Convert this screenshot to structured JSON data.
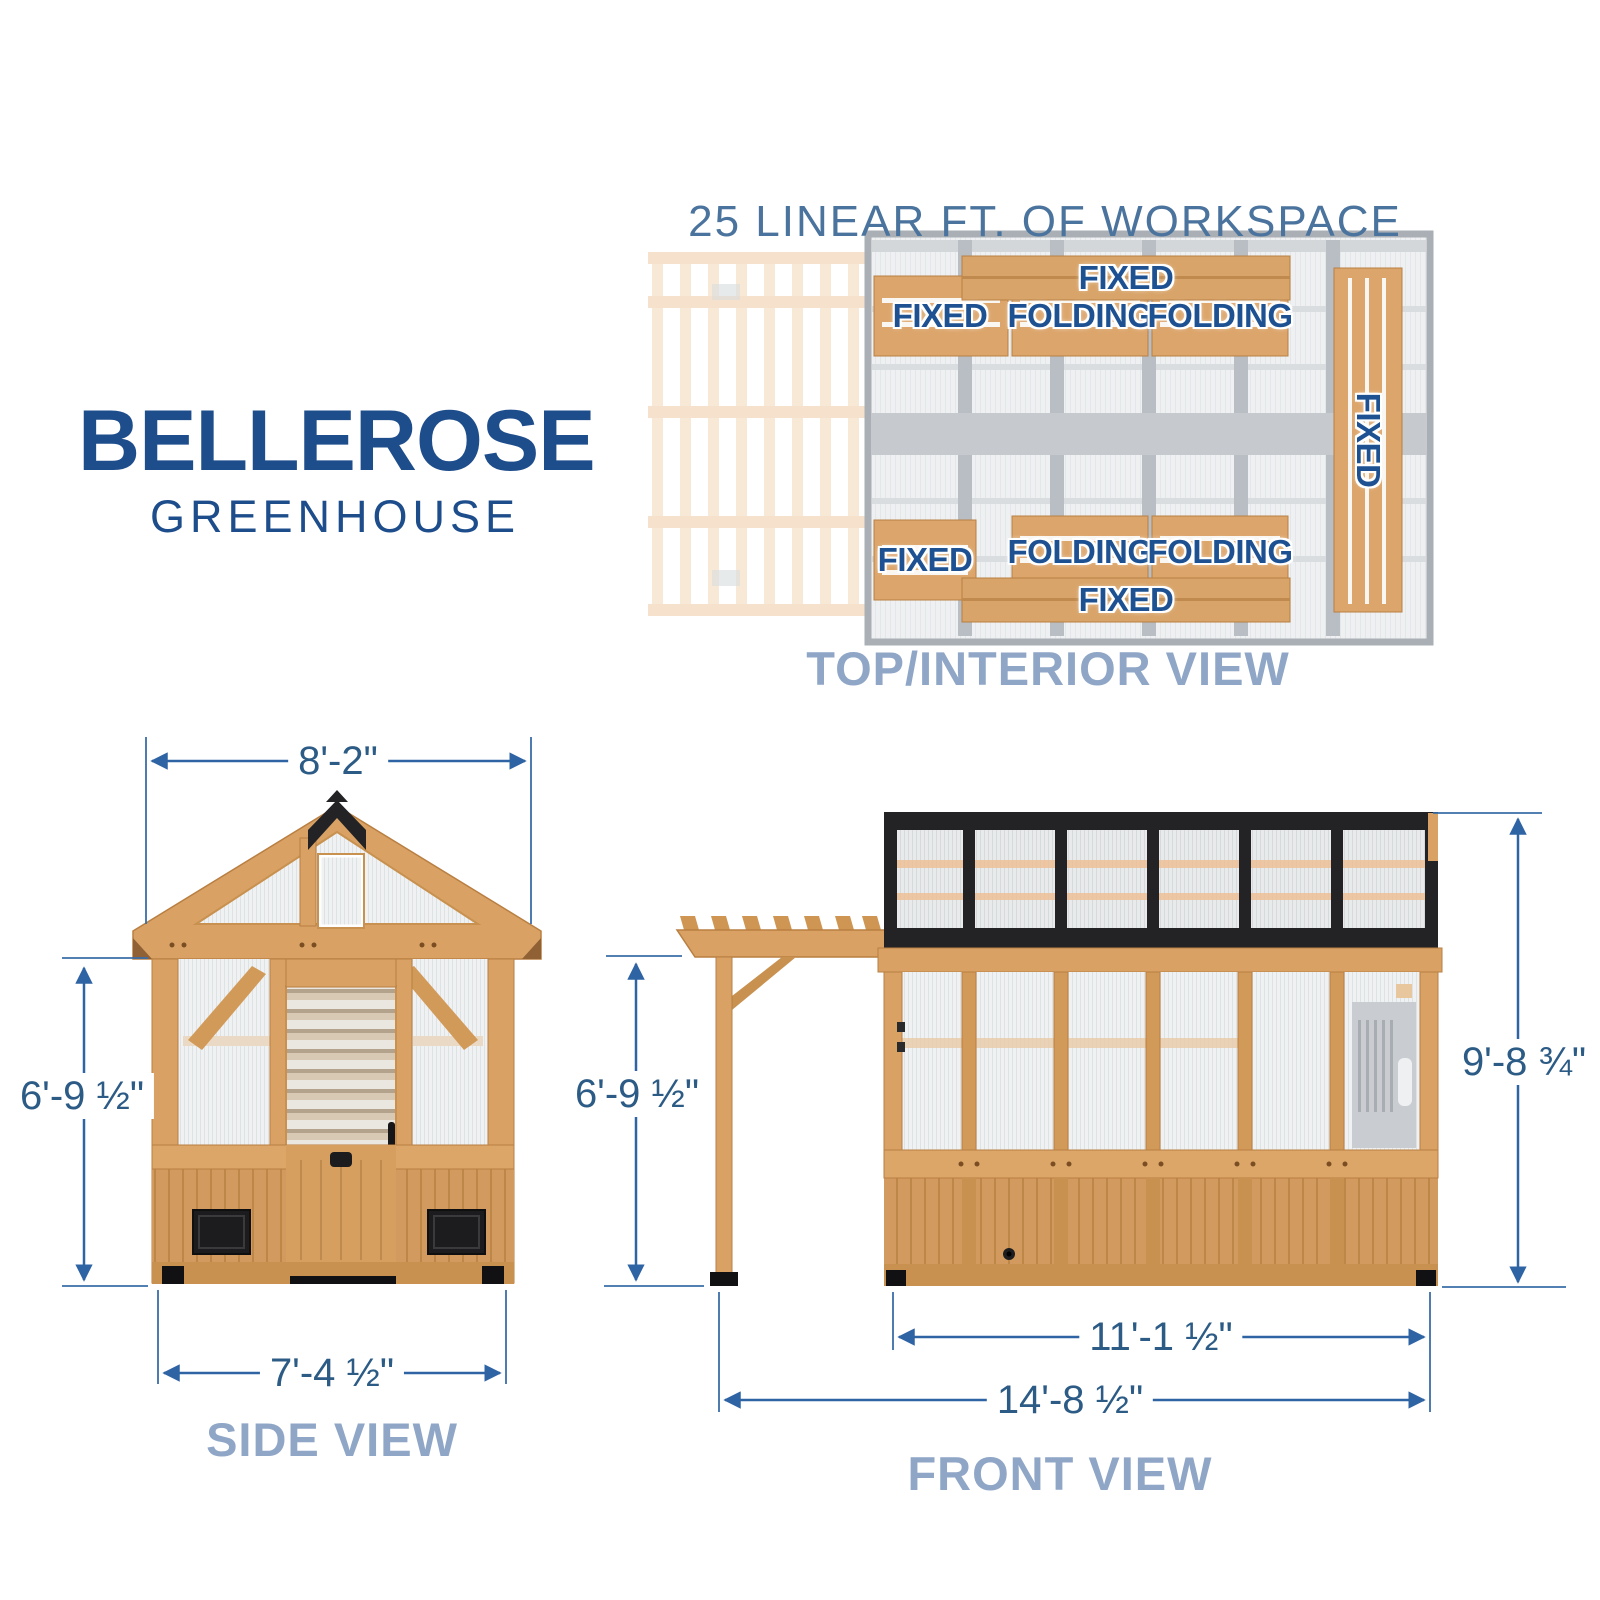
{
  "brand": {
    "name": "BELLEROSE",
    "subtitle": "GREENHOUSE"
  },
  "top_view": {
    "heading": "25 LINEAR FT. OF WORKSPACE",
    "caption": "TOP/INTERIOR VIEW",
    "shelves": [
      {
        "position": "back-wall-plank",
        "type": "FIXED"
      },
      {
        "position": "back-left",
        "type": "FIXED"
      },
      {
        "position": "back-middle",
        "type": "FOLDING"
      },
      {
        "position": "back-right",
        "type": "FOLDING"
      },
      {
        "position": "right-wall",
        "type": "FIXED"
      },
      {
        "position": "front-left",
        "type": "FIXED"
      },
      {
        "position": "front-middle",
        "type": "FOLDING"
      },
      {
        "position": "front-right",
        "type": "FOLDING"
      },
      {
        "position": "front-wall-plank",
        "type": "FIXED"
      }
    ]
  },
  "side_view": {
    "caption": "SIDE VIEW",
    "dimensions": {
      "roof_width": "8'-2\"",
      "wall_height": "6'-9 ½\"",
      "base_width": "7'-4 ½\""
    }
  },
  "front_view": {
    "caption": "FRONT VIEW",
    "dimensions": {
      "pergola_height": "6'-9 ½\"",
      "total_height": "9'-8 ¾\"",
      "greenhouse_width": "11'-1 ½\"",
      "total_width": "14'-8 ½\""
    }
  },
  "colors": {
    "brand_blue": "#1e4d8c",
    "heading_blue": "#4a739d",
    "caption_blue": "#8fa6c7",
    "dimension_text": "#2c5b85",
    "dimension_line": "#2f64a4",
    "shelf_label_blue": "#1d5191",
    "wood": "#d9a264",
    "wood_dark": "#c08a4e",
    "frame_black": "#232325",
    "floor_gray": "#eef0f1",
    "pergola_faded": "#f7e3cc"
  }
}
